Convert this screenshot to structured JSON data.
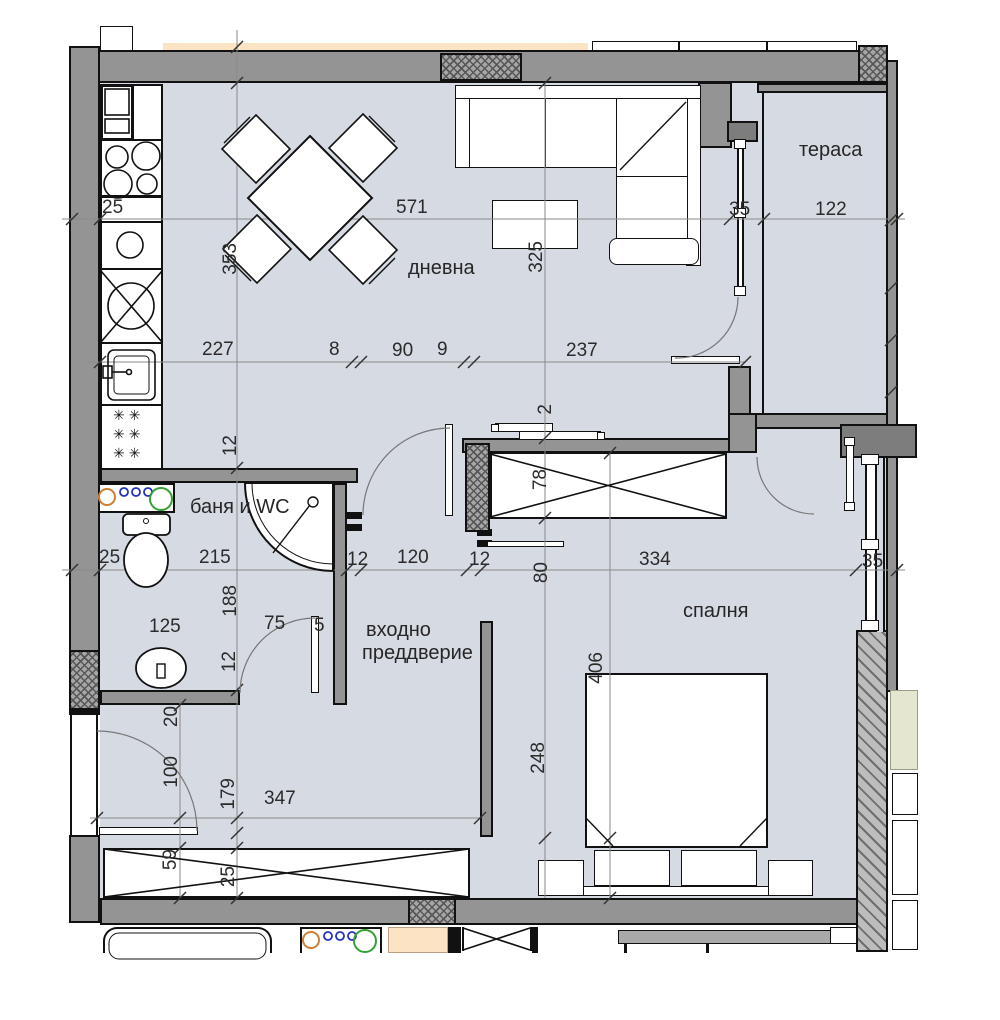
{
  "rooms": {
    "living": "дневна",
    "terrace": "тераса",
    "bath": "баня и WC",
    "hall_line1": "входно",
    "hall_line2": "преддверие",
    "bedroom": "спалня"
  },
  "dims": {
    "kitchen_25": "25",
    "living_width": "571",
    "terrace_door_35": "35",
    "terrace_122": "122",
    "kitchen_depth_353": "353",
    "sofa_325": "325",
    "line2_227": "227",
    "line2_8": "8",
    "line2_90": "90",
    "line2_9": "9",
    "line2_237": "237",
    "wall_12_a": "12",
    "closet_slide_2": "2",
    "closet_78": "78",
    "bath_wall_25": "25",
    "bath_215": "215",
    "hall_12_b": "12",
    "hall_120": "120",
    "hall_12_c": "12",
    "bed_334": "334",
    "window_35": "35",
    "bath_188": "188",
    "pass_80": "80",
    "bath_125": "125",
    "bath_door_75": "75",
    "pier_5": "5",
    "wall_12_d": "12",
    "bedroom_406": "406",
    "hall_20": "20",
    "entry_100": "100",
    "hall_179": "179",
    "hall_347": "347",
    "bed_248": "248",
    "wardrobe_59": "59",
    "wardrobe_25": "25"
  },
  "icons": {
    "radiator_row": "✳✳"
  },
  "colors": {
    "floor": "#d6dae3",
    "wall": "#949494",
    "wall_dark": "#7d7d7d",
    "neighbor_peach": "#fbe3c4",
    "neighbor_green": "#e4e6d0",
    "fixture_orange": "#cd7f32",
    "fixture_blue": "#2233bb",
    "fixture_green": "#35a035"
  }
}
